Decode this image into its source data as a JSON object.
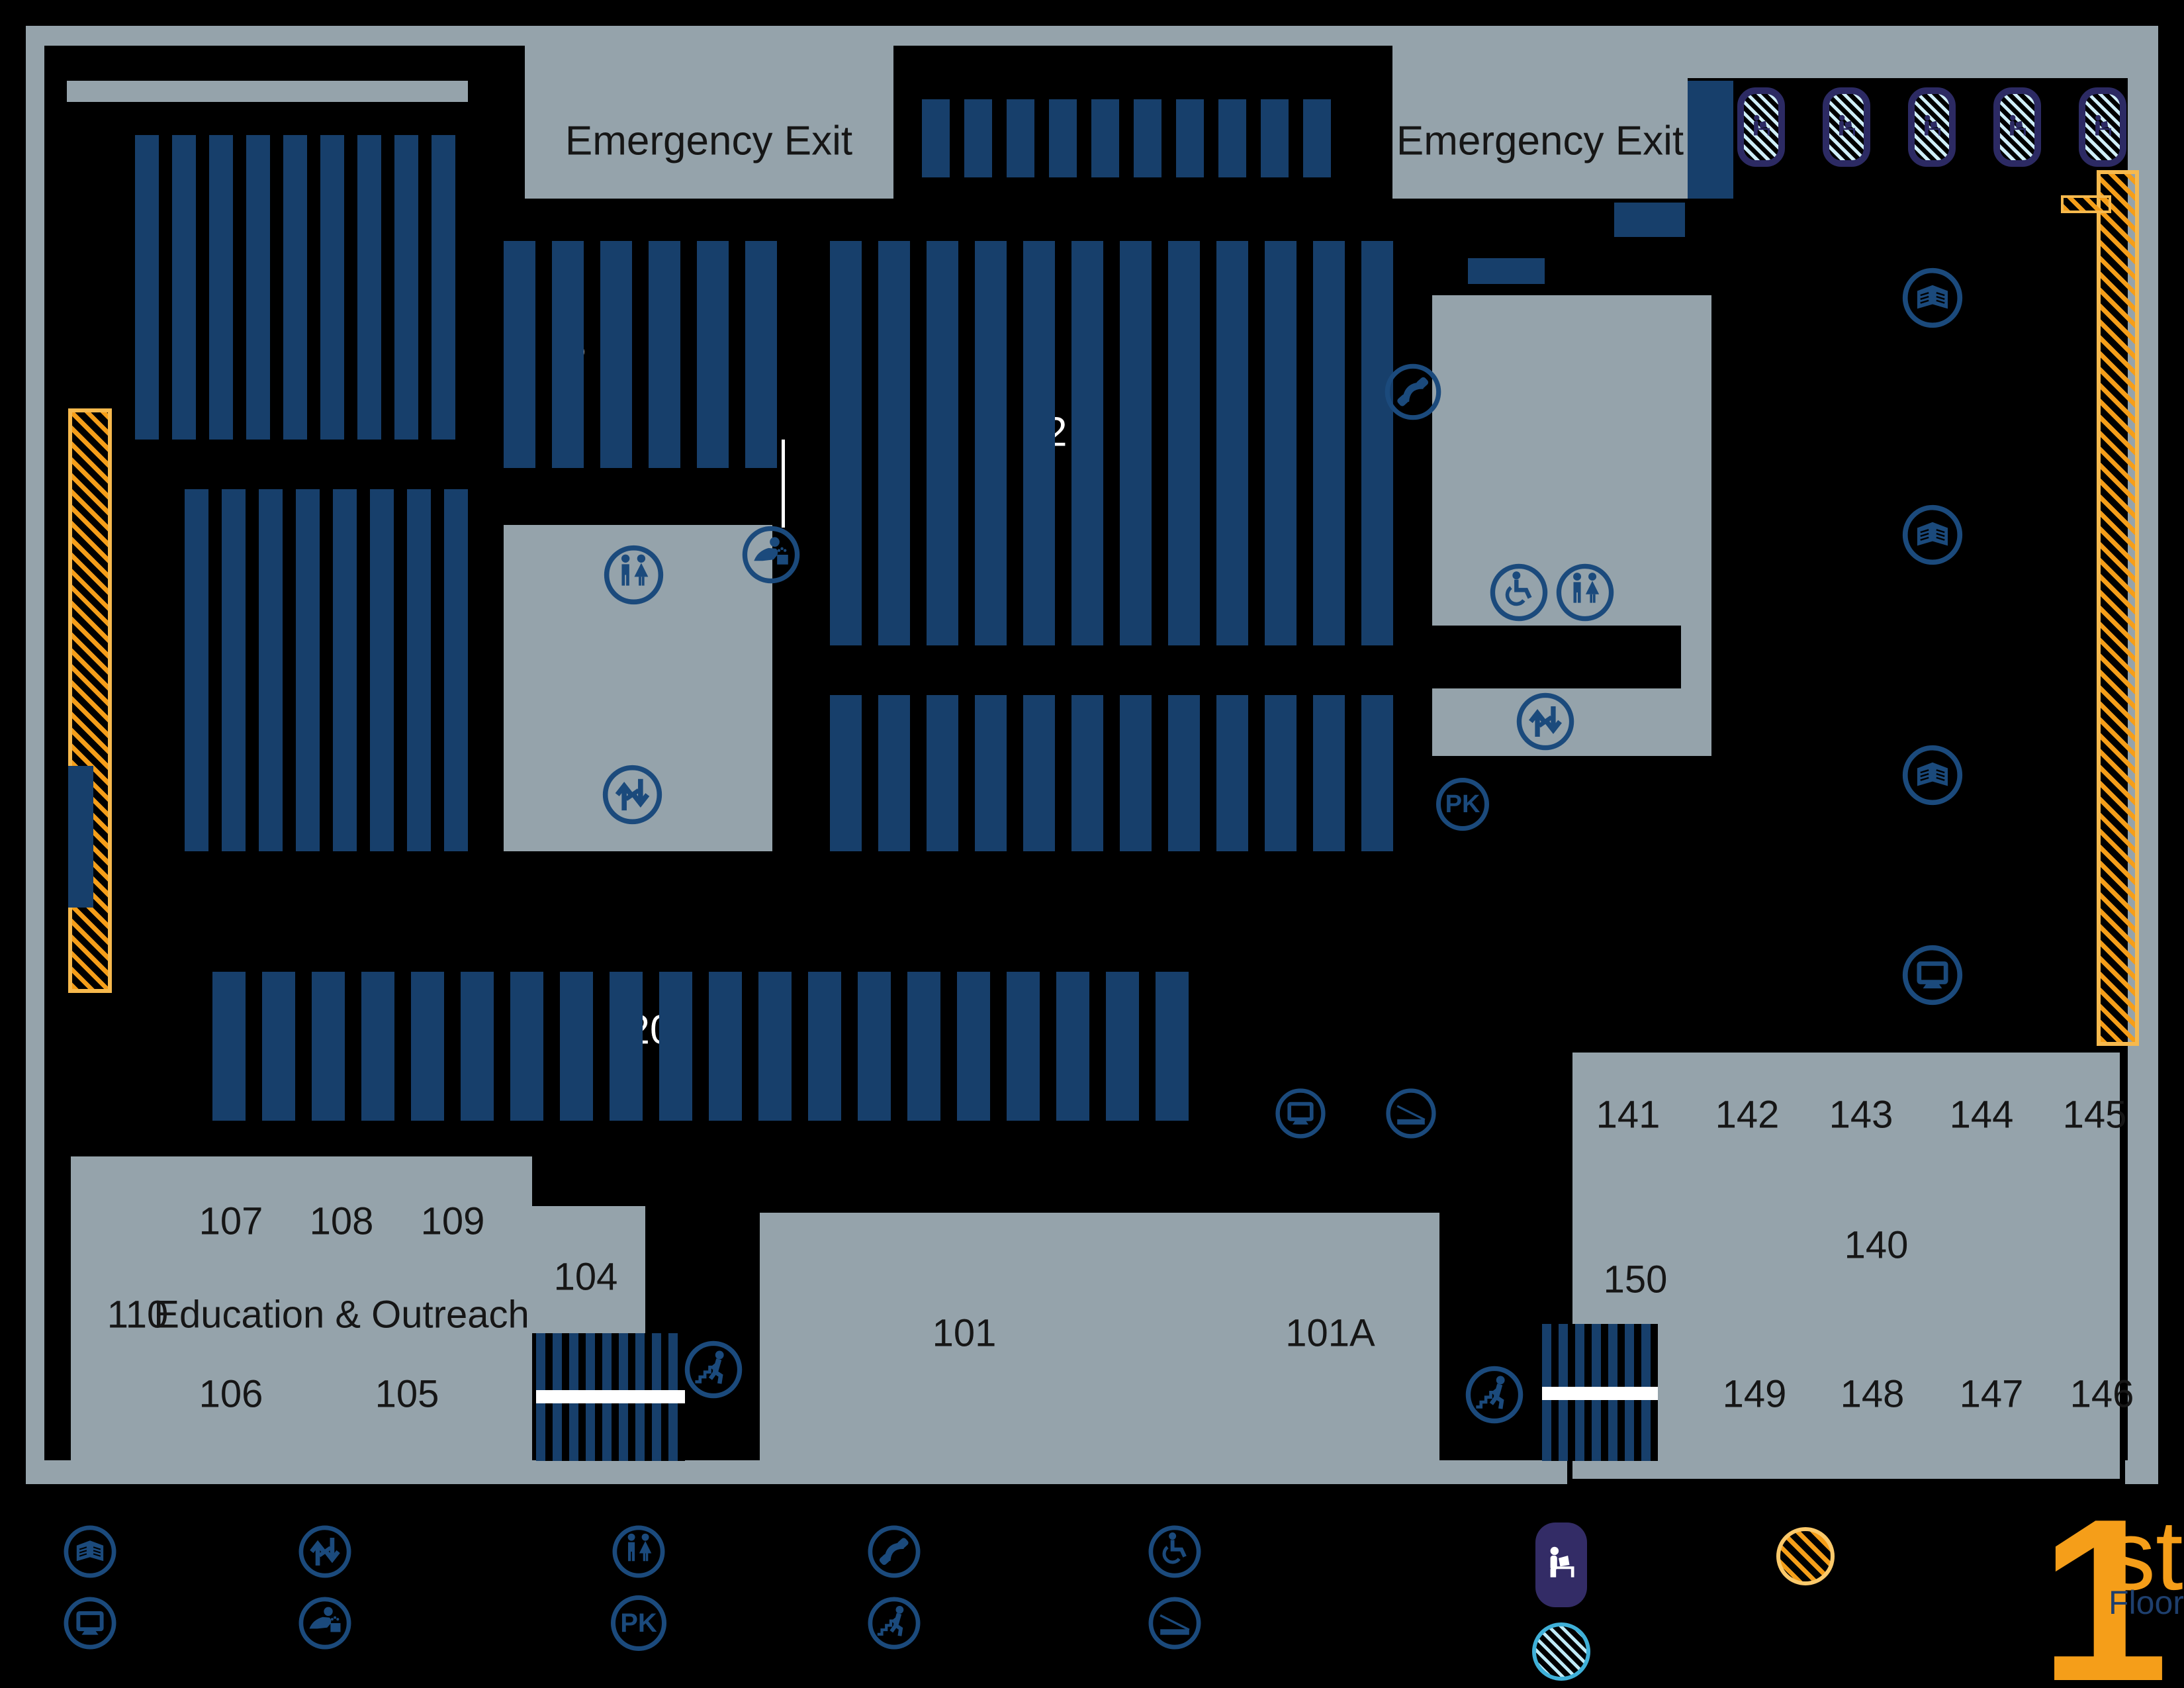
{
  "title": "Library First Floor Map",
  "labels": {
    "emergency_exit": "Emergency Exit",
    "education": "Education & Outreach",
    "pk": "PK"
  },
  "rooms": {
    "r101": "101",
    "r101a": "101A",
    "r104": "104",
    "r105": "105",
    "r106": "106",
    "r107": "107",
    "r108": "108",
    "r109": "109",
    "r110": "110",
    "r140": "140",
    "r141": "141",
    "r142": "142",
    "r143": "143",
    "r144": "144",
    "r145": "145",
    "r146": "146",
    "r147": "147",
    "r148": "148",
    "r149": "149",
    "r150": "150"
  },
  "stacks": {
    "s5": "5",
    "s12": "12",
    "s20": "20"
  },
  "floor": {
    "number": "1",
    "suffix": "st",
    "label": "Floor"
  },
  "legend": {
    "icons": [
      "books-stacks",
      "computers",
      "stairs-updown",
      "drinking-fountain",
      "restrooms",
      "pk",
      "telephone",
      "person-climbing-stairs",
      "wheelchair-accessible",
      "ramp",
      "study-carrel",
      "hatched-circle-cyan",
      "hatched-circle-yellow"
    ]
  },
  "colors": {
    "background": "#000000",
    "room_gray": "#95a3ab",
    "stack_blue": "#173f6b",
    "icon_blue": "#1b4a7c",
    "accent_orange": "#f59e19",
    "hatch_cyan": "#3fb0d8",
    "carrel_indigo": "#332c66",
    "logo_navy": "#1e3f6e"
  }
}
